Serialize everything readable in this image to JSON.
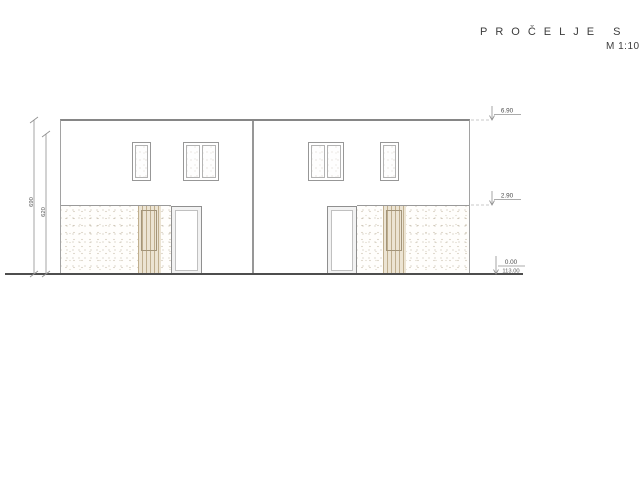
{
  "title": {
    "label": "PROČELJE S",
    "scale": "M 1:100"
  },
  "elevation": {
    "levels": [
      {
        "name": "roof-top",
        "value": "6.90"
      },
      {
        "name": "floor-slab",
        "value": "2.90"
      },
      {
        "name": "ground",
        "value": "0.00",
        "absolute": "113.00"
      }
    ],
    "dimensions": [
      {
        "name": "total-height",
        "value": "690"
      },
      {
        "name": "upper-height",
        "value": "620"
      }
    ]
  },
  "colors": {
    "outline": "#868686",
    "detail_line": "#9a9a9a",
    "ground_line": "#4e4e4e",
    "stipple_dot": "#c6bca9",
    "slat_strip": "#bfae8e",
    "text": "#3d3d3d"
  }
}
